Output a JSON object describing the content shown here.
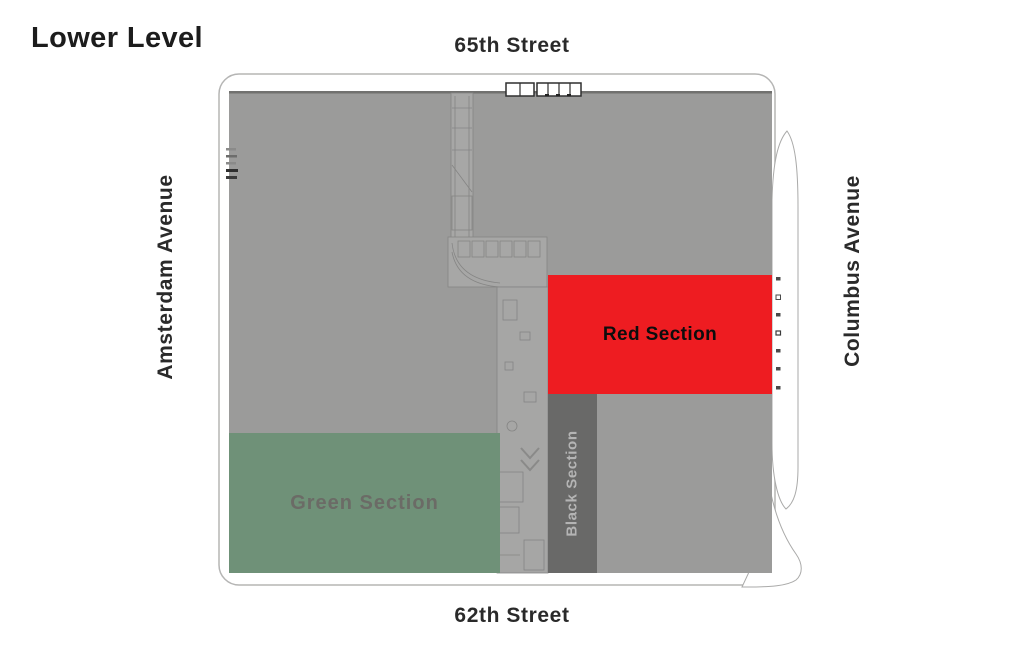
{
  "title": "Lower Level",
  "streets": {
    "top": "65th Street",
    "bottom": "62th Street",
    "left": "Amsterdam Avenue",
    "right": "Columbus Avenue"
  },
  "sections": {
    "red": {
      "label": "Red Section",
      "fill": "#ee1c21",
      "text": "#0d0d0d"
    },
    "green": {
      "label": "Green Section",
      "fill": "#6f9178",
      "text": "#6b6b66"
    },
    "black": {
      "label": "Black Section",
      "fill": "#696968",
      "text": "#b4b4b4"
    }
  },
  "plan": {
    "floor_fill": "#9b9b9a",
    "outline_stroke": "#b5b5b4"
  }
}
